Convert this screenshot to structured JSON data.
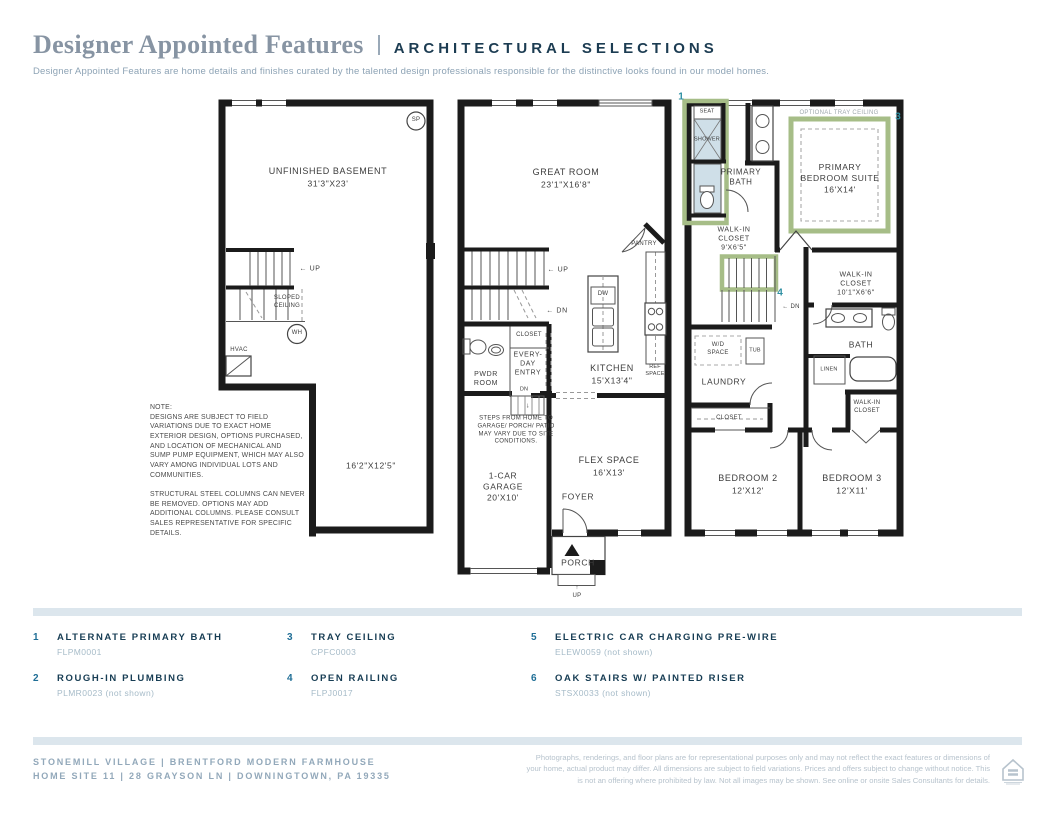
{
  "header": {
    "title": "Designer Appointed Features",
    "section": "ARCHITECTURAL SELECTIONS",
    "description": "Designer Appointed Features are home details and finishes curated by the talented design professionals responsible for the distinctive looks found in our model homes."
  },
  "plans": {
    "basement": {
      "sp_label": "SP",
      "room_name": "UNFINISHED BASEMENT",
      "room_dims": "31'3\"X23'",
      "up_label": "← UP",
      "sloped_ceiling": "SLOPED\nCEILING",
      "wh_label": "WH",
      "hvac_label": "HVAC",
      "room2_dims": "16'2\"X12'5\"",
      "note": "NOTE:\nDESIGNS ARE SUBJECT TO FIELD\nVARIATIONS DUE TO EXACT HOME\nEXTERIOR DESIGN, OPTIONS PURCHASED,\nAND LOCATION OF MECHANICAL AND\nSUMP PUMP EQUIPMENT, WHICH MAY ALSO\nVARY AMONG INDIVIDUAL LOTS AND\nCOMMUNITIES.\n\nSTRUCTURAL STEEL COLUMNS CAN NEVER\nBE REMOVED. OPTIONS MAY ADD\nADDITIONAL COLUMNS. PLEASE CONSULT\nSALES REPRESENTATIVE FOR SPECIFIC\nDETAILS."
    },
    "first_floor": {
      "great_room_name": "GREAT ROOM",
      "great_room_dims": "23'1\"X16'8\"",
      "pantry": "PANTRY",
      "up_label": "← UP",
      "dn_label": "← DN",
      "closet": "CLOSET",
      "pwdr_room": "PWDR\nROOM",
      "everyday_entry": "EVERY-\nDAY\nENTRY",
      "entry_dn": "DN",
      "entry_arrow": "↓",
      "dw": "DW",
      "kitchen_name": "KITCHEN",
      "kitchen_dims": "15'X13'4\"",
      "ref_space": "REF\nSPACE",
      "steps_note": "STEPS FROM HOME TO\nGARAGE/ PORCH/ PATIO\nMAY VARY DUE TO SITE\nCONDITIONS.",
      "garage": "1-CAR\nGARAGE\n20'X10'",
      "flex_name": "FLEX SPACE",
      "flex_dims": "16'X13'",
      "foyer": "FOYER",
      "porch": "PORCH",
      "porch_up": "↑\nUP"
    },
    "second_floor": {
      "marker_1": "1",
      "marker_3": "3",
      "marker_4": "4",
      "seat": "SEAT",
      "shower": "SHOWER",
      "primary_bath": "PRIMARY\nBATH",
      "tray_ceiling": "OPTIONAL TRAY CEILING",
      "suite_name": "PRIMARY\nBEDROOM SUITE",
      "suite_dims": "16'X14'",
      "wic_primary": "WALK-IN\nCLOSET\n9'X6'5\"",
      "dn_label": "← DN",
      "wd_space": "W/D\nSPACE",
      "tub": "TUB",
      "laundry": "LAUNDRY",
      "wic_hall": "WALK-IN\nCLOSET\n10'1\"X6'6\"",
      "bath": "BATH",
      "linen": "LINEN",
      "wic_bed3": "WALK-IN\nCLOSET",
      "closet": "CLOSET",
      "bedroom2_name": "BEDROOM 2",
      "bedroom2_dims": "12'X12'",
      "bedroom3_name": "BEDROOM 3",
      "bedroom3_dims": "12'X11'"
    }
  },
  "features": [
    {
      "num": "1",
      "name": "ALTERNATE PRIMARY BATH",
      "code": "FLPM0001"
    },
    {
      "num": "2",
      "name": "ROUGH-IN PLUMBING",
      "code": "PLMR0023 (not shown)"
    },
    {
      "num": "3",
      "name": "TRAY CEILING",
      "code": "CPFC0003"
    },
    {
      "num": "4",
      "name": "OPEN RAILING",
      "code": "FLPJ0017"
    },
    {
      "num": "5",
      "name": "ELECTRIC CAR CHARGING PRE-WIRE",
      "code": "ELEW0059 (not shown)"
    },
    {
      "num": "6",
      "name": "OAK STAIRS W/ PAINTED RISER",
      "code": "STSX0033 (not shown)"
    }
  ],
  "footer": {
    "community_line": "STONEMILL VILLAGE  |  BRENTFORD MODERN FARMHOUSE",
    "address_line": "HOME SITE 11  |  28 GRAYSON LN  |  DOWNINGTOWN, PA 19335",
    "disclaimer": "Photographs, renderings, and floor plans are for representational purposes only and may not reflect the exact features or dimensions of your home, actual product may differ. All dimensions are subject to field variations. Prices and offers subject to change without notice. This is not an offering where prohibited by law. Not all images may be shown. See online or onsite Sales Consultants for details."
  },
  "colors": {
    "accent_navy": "#173d54",
    "muted_blue": "#92a8ba",
    "marker_teal": "#2e8fa3",
    "highlight_green": "#a6bd87",
    "fixture_blue": "#cfdfe8",
    "divider_bar": "#dce6ed"
  }
}
